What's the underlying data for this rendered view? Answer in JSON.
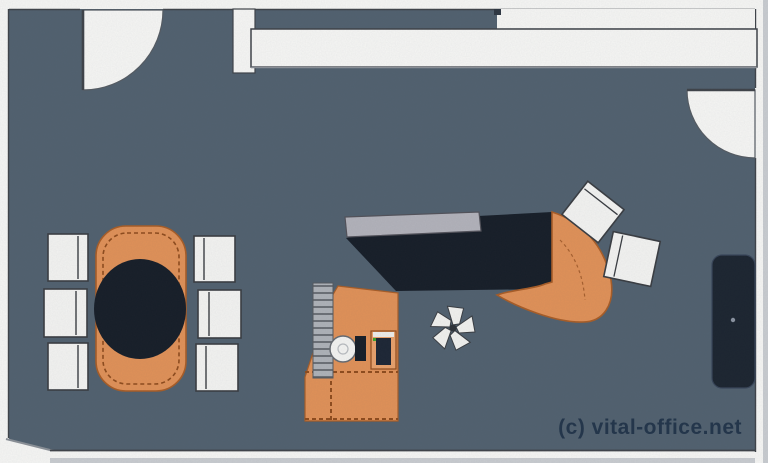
{
  "watermark": {
    "text": "(c) vital-office.net"
  },
  "colors": {
    "floor": "#51616f",
    "wall_fill": "#f6f6f4",
    "wall_line": "#3f4349",
    "wall_shadow": "#c9ccd0",
    "orange": "#e09158",
    "orange_dark": "#a85d27",
    "orange_dash": "#8f4c1d",
    "dark_furniture": "#171e28",
    "chair_fill": "#f3f3f1",
    "chair_line": "#3a3d42",
    "panel_gray": "#b2b2ba",
    "rail_gray": "#aeb2b8",
    "plant_fill": "#f1f1ee",
    "watermark_color": "#1d2f45"
  }
}
